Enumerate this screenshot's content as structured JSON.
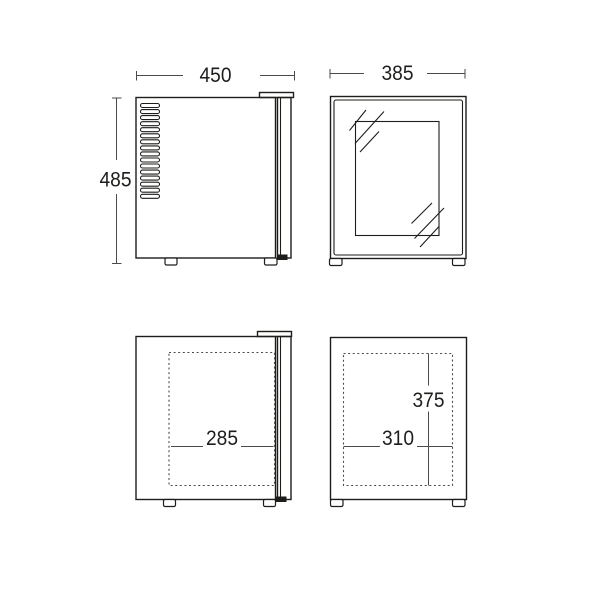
{
  "drawing": {
    "colors": {
      "outline": "#1d1d1b",
      "dimension_line": "#4a4a4a",
      "background": "#ffffff"
    },
    "views": {
      "side_top": {
        "width": "450",
        "height": "485"
      },
      "front_top": {
        "width": "385"
      },
      "side_bottom": {
        "interior_depth": "285"
      },
      "front_bottom": {
        "interior_width": "310",
        "interior_height": "375"
      }
    }
  }
}
